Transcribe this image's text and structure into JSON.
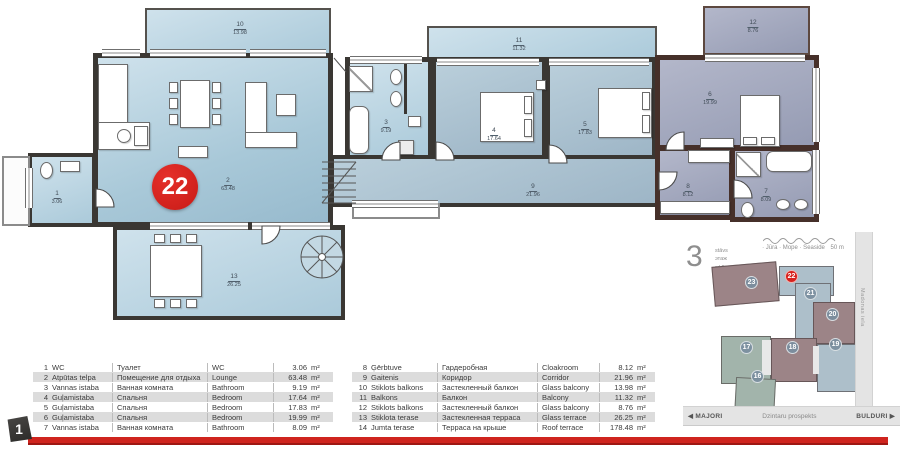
{
  "accent": {
    "red": "#d7221e",
    "wall_left": "#3a3733",
    "wall_right": "#46302a"
  },
  "unit_badge": {
    "number": "22"
  },
  "page_tab": {
    "number": "1"
  },
  "plan_rooms": [
    {
      "num": "1",
      "area": "3.06"
    },
    {
      "num": "2",
      "area": "63.48"
    },
    {
      "num": "3",
      "area": "9.19"
    },
    {
      "num": "4",
      "area": "17.64"
    },
    {
      "num": "5",
      "area": "17.83"
    },
    {
      "num": "6",
      "area": "19.99"
    },
    {
      "num": "7",
      "area": "8.09"
    },
    {
      "num": "8",
      "area": "8.12"
    },
    {
      "num": "9",
      "area": "21.96"
    },
    {
      "num": "10",
      "area": "13.98"
    },
    {
      "num": "11",
      "area": "11.32"
    },
    {
      "num": "12",
      "area": "8.76"
    },
    {
      "num": "13",
      "area": "26.25"
    }
  ],
  "minimap": {
    "floor": {
      "big": "3",
      "lines": [
        "stāvs",
        "этаж",
        "rd floor"
      ]
    },
    "sea": {
      "names": "· Jūra · Море · Seaside",
      "distance": "50 m"
    },
    "streets": {
      "left": "MAJORI",
      "left_arrow": "◀",
      "center": "Dzintaru prospekts",
      "right": "BULDURI",
      "right_arrow": "▶",
      "vertical": "Madonas iela"
    },
    "units": [
      {
        "label": "23"
      },
      {
        "label": "22"
      },
      {
        "label": "21"
      },
      {
        "label": "20"
      },
      {
        "label": "19"
      },
      {
        "label": "18"
      },
      {
        "label": "17"
      },
      {
        "label": "16"
      }
    ]
  },
  "legend": {
    "rows_left": [
      {
        "n": "1",
        "lv": "WC",
        "ru": "Туалет",
        "en": "WC",
        "area": "3.06",
        "unit": "m²"
      },
      {
        "n": "2",
        "lv": "Atpūtas telpa",
        "ru": "Помещение для отдыха",
        "en": "Lounge",
        "area": "63.48",
        "unit": "m²"
      },
      {
        "n": "3",
        "lv": "Vannas istaba",
        "ru": "Ванная комната",
        "en": "Bathroom",
        "area": "9.19",
        "unit": "m²"
      },
      {
        "n": "4",
        "lv": "Guļamistaba",
        "ru": "Спальня",
        "en": "Bedroom",
        "area": "17.64",
        "unit": "m²"
      },
      {
        "n": "5",
        "lv": "Guļamistaba",
        "ru": "Спальня",
        "en": "Bedroom",
        "area": "17.83",
        "unit": "m²"
      },
      {
        "n": "6",
        "lv": "Guļamistaba",
        "ru": "Спальня",
        "en": "Bedroom",
        "area": "19.99",
        "unit": "m²"
      },
      {
        "n": "7",
        "lv": "Vannas istaba",
        "ru": "Ванная комната",
        "en": "Bathroom",
        "area": "8.09",
        "unit": "m²"
      }
    ],
    "rows_right": [
      {
        "n": "8",
        "lv": "Ģērbtuve",
        "ru": "Гардеробная",
        "en": "Cloakroom",
        "area": "8.12",
        "unit": "m²"
      },
      {
        "n": "9",
        "lv": "Gaitenis",
        "ru": "Коридор",
        "en": "Corridor",
        "area": "21.96",
        "unit": "m²"
      },
      {
        "n": "10",
        "lv": "Stiklots balkons",
        "ru": "Застекленный балкон",
        "en": "Glass balcony",
        "area": "13.98",
        "unit": "m²"
      },
      {
        "n": "11",
        "lv": "Balkons",
        "ru": "Балкон",
        "en": "Balcony",
        "area": "11.32",
        "unit": "m²"
      },
      {
        "n": "12",
        "lv": "Stiklots balkons",
        "ru": "Застекленный балкон",
        "en": "Glass balcony",
        "area": "8.76",
        "unit": "m²"
      },
      {
        "n": "13",
        "lv": "Stiklota terase",
        "ru": "Застекленная терраса",
        "en": "Glass terrace",
        "area": "26.25",
        "unit": "m²"
      },
      {
        "n": "14",
        "lv": "Jumta terase",
        "ru": "Терраса на крыше",
        "en": "Roof terrace",
        "area": "178.48",
        "unit": "m²"
      }
    ]
  }
}
